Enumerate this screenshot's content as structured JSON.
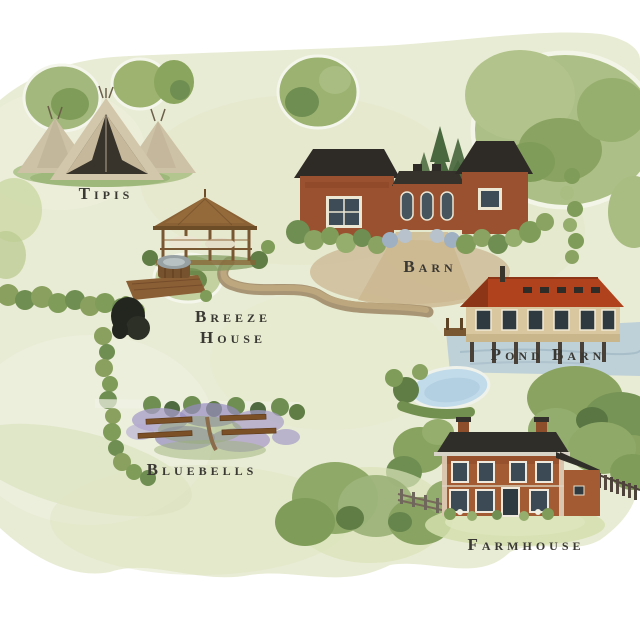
{
  "map": {
    "type": "illustrated-venue-map",
    "labels": {
      "tipis": "Tipis",
      "barn": "Barn",
      "breeze_line1": "Breeze",
      "breeze_line2": "House",
      "pond_barn": "Pond Barn",
      "bluebells": "Bluebells",
      "farmhouse": "Farmhouse"
    },
    "palette": {
      "wash_green": "#e9ecd4",
      "tree_green": "#9cb176",
      "tree_dark": "#62814a",
      "conifer_dark": "#4a6840",
      "brick_red": "#9a5130",
      "roof_charcoal": "#2e2b26",
      "terracotta_roof": "#b0431d",
      "stone_cream": "#d9c89f",
      "water_blue": "#bccfd8",
      "pond_blue": "#c2dbea",
      "path_tan": "#ac9571",
      "canvas_tan": "#cdc1a6",
      "bluebell_purple": "#9a8fc4",
      "bench_brown": "#7c5026",
      "label_ink": "#3a3833"
    },
    "features": [
      {
        "id": "tipis",
        "name": "tipi-tents-icon"
      },
      {
        "id": "barn",
        "name": "barn-building-icon"
      },
      {
        "id": "breeze-house",
        "name": "gazebo-icon"
      },
      {
        "id": "hot-tub",
        "name": "hot-tub-deck-icon"
      },
      {
        "id": "pond-barn",
        "name": "pond-barn-building-icon"
      },
      {
        "id": "pond",
        "name": "pond-icon"
      },
      {
        "id": "bluebells",
        "name": "bluebell-benches-icon"
      },
      {
        "id": "farmhouse",
        "name": "farmhouse-building-icon"
      },
      {
        "id": "footpath",
        "name": "footpath-icon"
      }
    ]
  }
}
